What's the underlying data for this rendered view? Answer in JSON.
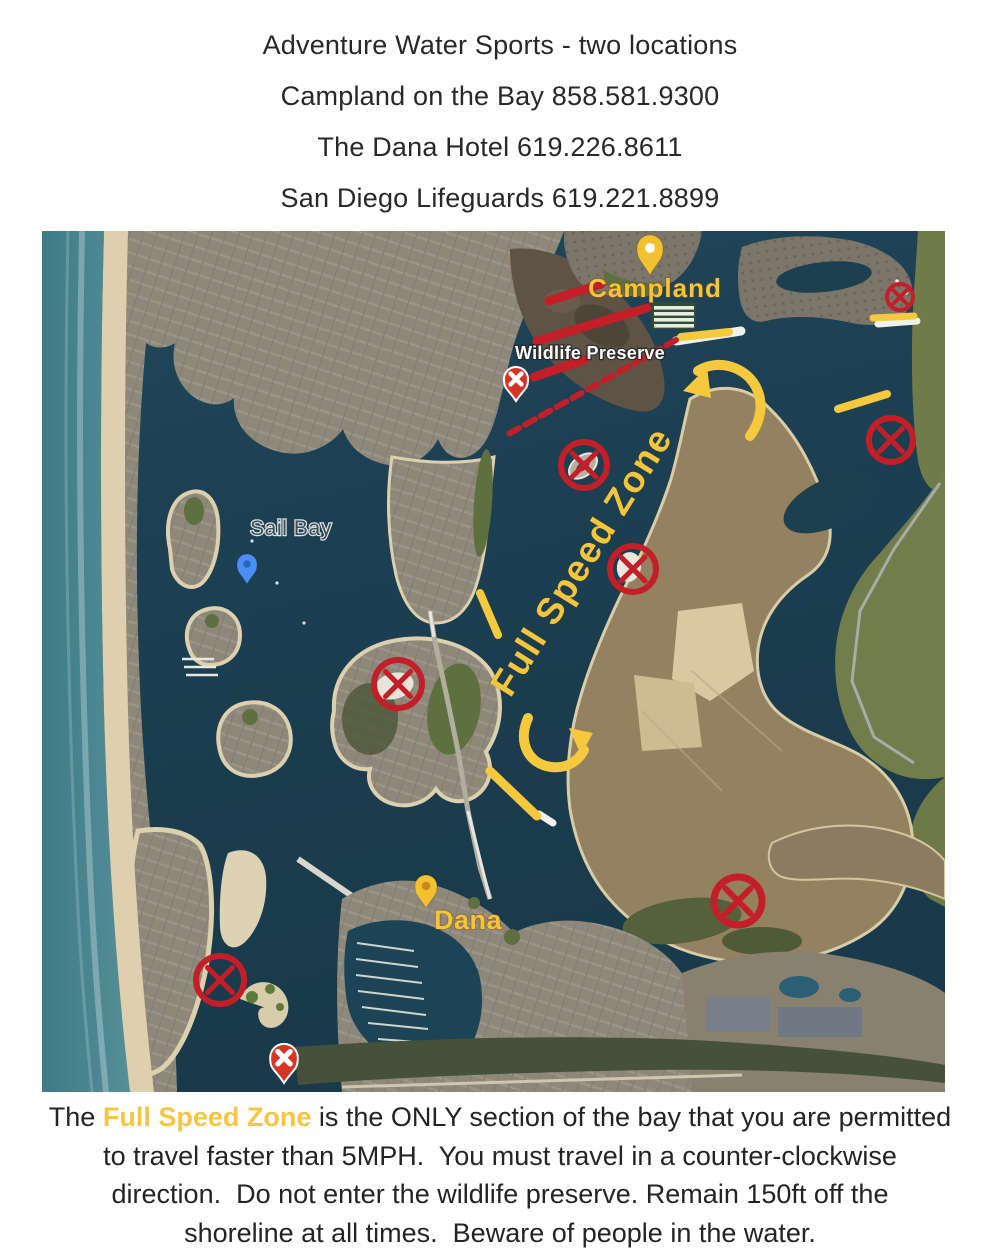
{
  "header": {
    "lines": [
      "Adventure Water Sports - two locations",
      "Campland on the Bay 858.581.9300",
      "The Dana Hotel 619.226.8611",
      "San Diego Lifeguards 619.221.8899"
    ]
  },
  "map": {
    "colors": {
      "annotation_red": "#c41e28",
      "annotation_yellow": "#f5c83e",
      "jetty_white": "#f1f1ec",
      "pin_yellow": "#f3c130",
      "pin_blue": "#4a90f4",
      "pin_red": "#d63426",
      "label_gold": "#f6c437",
      "label_white": "#ffffff",
      "sail_bay_text": "#3e4d56"
    },
    "region_labels": [
      {
        "id": "campland-label",
        "text": "Campland",
        "x": 613,
        "y": 66,
        "size": 26,
        "weight": 700,
        "color": "#f6c437",
        "halo": "rgba(130,60,10,0.35)",
        "halo_w": 2,
        "rotate": 0,
        "spacing": 1
      },
      {
        "id": "wildlife-preserve-label",
        "text": "Wildlife Preserve",
        "x": 548,
        "y": 128,
        "size": 18,
        "weight": 700,
        "color": "#ffffff",
        "halo": "rgba(40,40,40,0.85)",
        "halo_w": 2.6,
        "rotate": 0,
        "spacing": 0.3
      },
      {
        "id": "sail-bay-label",
        "text": "Sail Bay",
        "x": 249,
        "y": 304,
        "size": 21,
        "weight": 500,
        "color": "#3e4d56",
        "halo": "rgba(255,255,255,0.85)",
        "halo_w": 2.4,
        "rotate": 0,
        "spacing": 0.6
      },
      {
        "id": "full-speed-zone-label",
        "text": "Full Speed Zone",
        "x": 550,
        "y": 337,
        "size": 37,
        "weight": 700,
        "color": "#f2c53d",
        "halo": "rgba(60,40,0,0.18)",
        "halo_w": 1.5,
        "rotate": -58,
        "spacing": 1.5
      },
      {
        "id": "dana-label",
        "text": "Dana",
        "x": 426,
        "y": 698,
        "size": 27,
        "weight": 700,
        "color": "#f6c437",
        "halo": "rgba(130,60,10,0.35)",
        "halo_w": 2,
        "rotate": 0,
        "spacing": 0.5
      }
    ],
    "location_pins": [
      {
        "id": "campland-pin",
        "tipx": 608,
        "tipy": 44,
        "head_r": 13,
        "height": 40,
        "fill": "#f3c130",
        "hole": "#ffffff"
      },
      {
        "id": "dana-pin",
        "tipx": 384,
        "tipy": 677,
        "head_r": 11,
        "height": 33,
        "fill": "#f3c130",
        "hole": "#c08a27"
      },
      {
        "id": "sail-bay-pin",
        "tipx": 205,
        "tipy": 353,
        "head_r": 10,
        "height": 30,
        "fill": "#4a90f4",
        "hole": "#2c64c4"
      }
    ],
    "x_circle_markers": [
      {
        "x": 858,
        "y": 66,
        "r": 13,
        "sw": 4
      },
      {
        "x": 849,
        "y": 209,
        "r": 22,
        "sw": 6
      },
      {
        "x": 542,
        "y": 234,
        "r": 23,
        "sw": 6
      },
      {
        "x": 591,
        "y": 338,
        "r": 23,
        "sw": 6
      },
      {
        "x": 356,
        "y": 453,
        "r": 24,
        "sw": 6
      },
      {
        "x": 178,
        "y": 749,
        "r": 24,
        "sw": 6
      },
      {
        "x": 696,
        "y": 670,
        "r": 24,
        "sw": 7
      }
    ],
    "x_pin_markers": [
      {
        "x": 474,
        "y": 170,
        "scale": 1.0
      },
      {
        "x": 242,
        "y": 852,
        "scale": 1.15
      }
    ],
    "boundary_lines_yellow": [
      [
        831,
        87,
        872,
        85,
        7
      ],
      [
        796,
        178,
        845,
        163,
        8
      ],
      [
        438,
        362,
        456,
        404,
        8
      ],
      [
        448,
        540,
        495,
        585,
        9
      ],
      [
        639,
        106,
        687,
        101,
        8
      ]
    ],
    "jetty_lines_white": [
      [
        634,
        110,
        699,
        100,
        9
      ],
      [
        836,
        93,
        875,
        90,
        7
      ],
      [
        497,
        583,
        511,
        592,
        7
      ]
    ],
    "preserve_hatch_lines_red": [
      [
        507,
        70,
        559,
        53
      ],
      [
        495,
        110,
        605,
        77
      ],
      [
        492,
        146,
        542,
        129
      ]
    ],
    "preserve_boundary_dashed_red": {
      "x1": 634,
      "y1": 109,
      "x2": 463,
      "y2": 205,
      "w": 6,
      "dash": "11 7"
    },
    "direction_arrows": [
      {
        "id": "counter-clockwise-arrow-north",
        "path": "M 708 205 C 719 190 722 172 714 156 C 704 136 676 127 656 140",
        "head": "641,160 665,136 669,167"
      },
      {
        "id": "counter-clockwise-arrow-south",
        "path": "M 486 487 C 475 512 487 533 509 536 C 526 538 537 529 542 519",
        "head": "551,502 527,497 539,524"
      }
    ]
  },
  "footer": {
    "line1_pre": "The ",
    "line1_highlight": "Full Speed Zone",
    "line1_post": " is the ONLY section of the bay that you are permitted",
    "line2": "to travel faster than 5MPH.  You must travel in a counter-clockwise",
    "line3": "direction.  Do not enter the wildlife preserve. Remain 150ft off the",
    "line4": "shoreline at all times.  Beware of people in the water.",
    "highlight_color": "#f6c544"
  }
}
